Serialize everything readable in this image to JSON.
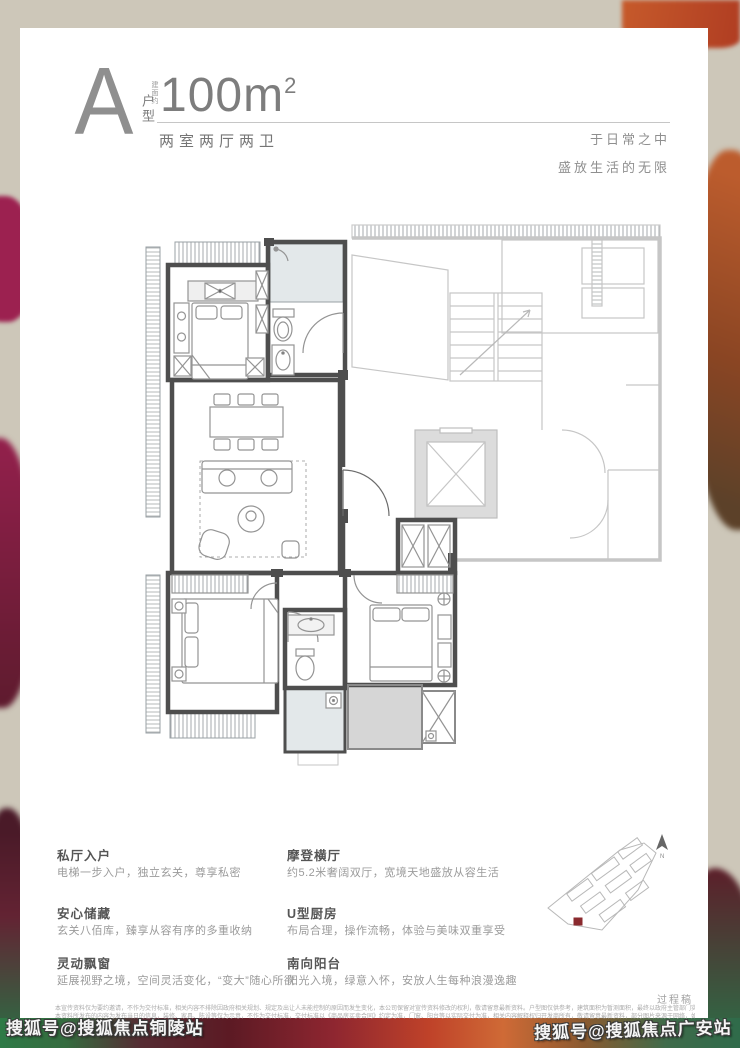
{
  "header": {
    "type_letter": "A",
    "type_label": "户型",
    "area_prefix": "建面约",
    "area_value": "100m",
    "area_sup": "2",
    "layout": "两室两厅两卫",
    "slogan_line1": "于日常之中",
    "slogan_line2": "盛放生活的无限"
  },
  "features": {
    "left": [
      {
        "title": "私厅入户",
        "desc": "电梯一步入户，独立玄关，尊享私密"
      },
      {
        "title": "安心储藏",
        "desc": "玄关八佰库，臻享从容有序的多重收纳"
      },
      {
        "title": "灵动飘窗",
        "desc": "延展视野之境，空间灵活变化，“变大”随心所欲"
      }
    ],
    "right": [
      {
        "title": "摩登横厅",
        "desc": "约5.2米奢阔双厅，宽境天地盛放从容生活"
      },
      {
        "title": "U型厨房",
        "desc": "布局合理，操作流畅，体验与美味双重享受"
      },
      {
        "title": "南向阳台",
        "desc": "阳光入境，绿意入怀，安放人生每种浪漫逸趣"
      }
    ]
  },
  "sitemap": {
    "draft_label": "过程稿"
  },
  "disclaimer": {
    "line1": "本宣传资料仅为要约邀请，不作为交付标准，相关内容不排除因政府相关规划、规定及出让人未能控制的原因而发生变化，本公司保留对宣传资料修改的权利，敬请留意最新资料。户型图仅供参考，建筑面积为暂测面积，最终以政府主管部门实测面积为准。",
    "line2": "本资料所发布的内容为发布当日的信息，装修、家具、陈设等仅为示意，不作为交付标准，交付标准以《商品房买卖合同》约定为准，门窗、阳台等以实际交付为准，相关内容解释权归开发商所有，敬请留意最新资料，部分图片来源于网络，如有侵权请联系删除。"
  },
  "watermarks": {
    "left": "搜狐号@搜狐焦点铜陵站",
    "right": "搜狐号@搜狐焦点广安站"
  },
  "colors": {
    "page_bg": "#cdc7b9",
    "card_bg": "#ffffff",
    "unit_wall": "#4e4e4e",
    "common_wall": "#c6c6c6",
    "glass_fill": "#e3e8ea",
    "accent_red": "#8a2a2e"
  }
}
